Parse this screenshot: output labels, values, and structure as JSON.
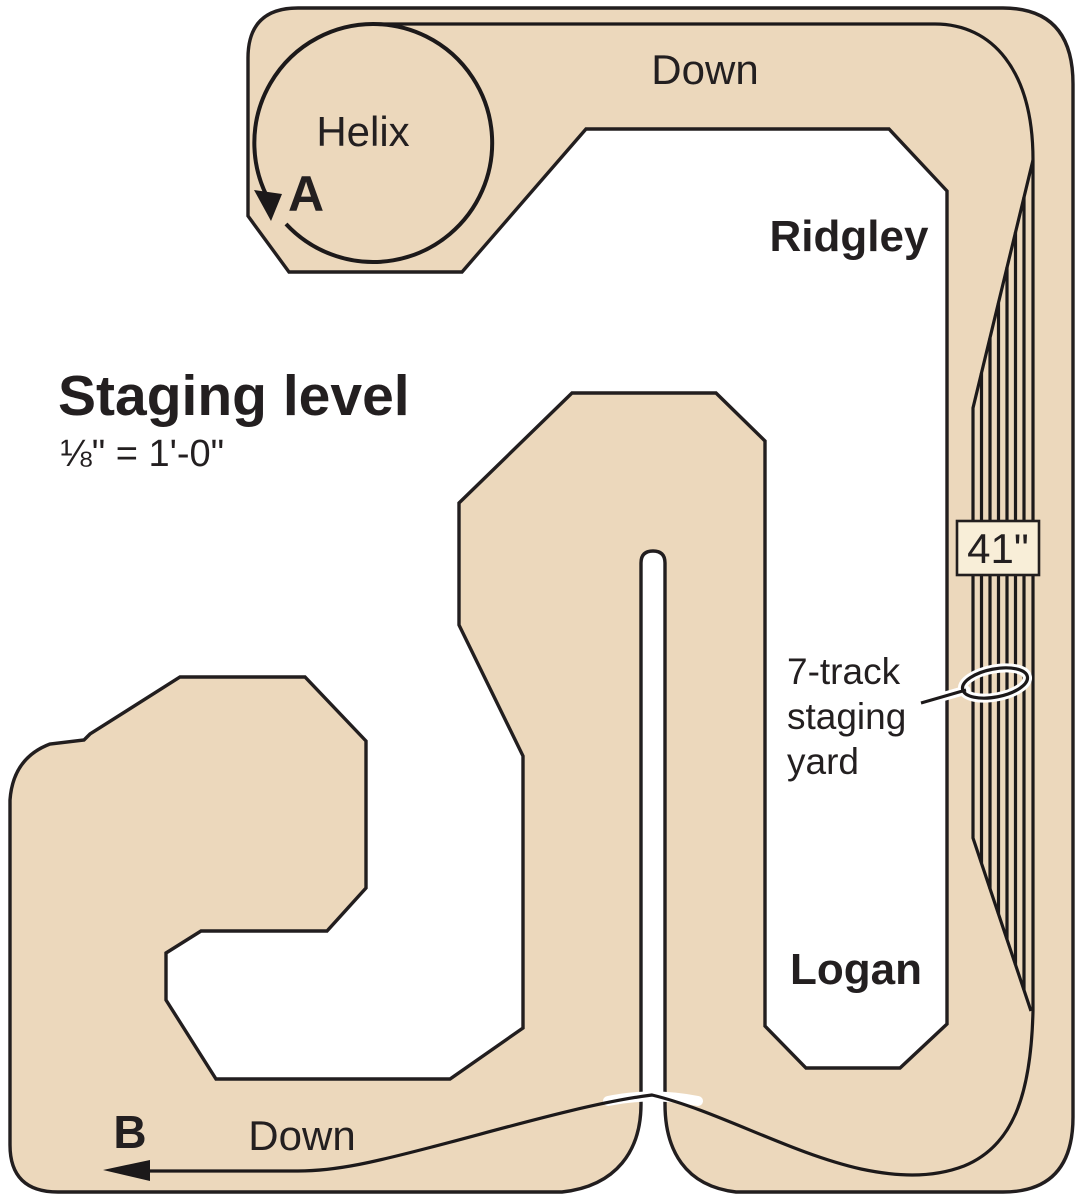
{
  "diagram": {
    "title": "Staging level",
    "scale_note": "⅛\" = 1'-0\"",
    "helix_label": "Helix",
    "connection_points": {
      "a": "A",
      "b": "B"
    },
    "direction_labels": {
      "top": "Down",
      "bottom": "Down"
    },
    "towns": {
      "ridgley": "Ridgley",
      "logan": "Logan"
    },
    "height_marker": "41\"",
    "yard_callout": {
      "line1": "7-track",
      "line2": "staging",
      "line3": "yard"
    },
    "colors": {
      "benchwork": "#ecd8bc",
      "marker_box": "#f8eed8",
      "ink": "#231f20",
      "background": "#ffffff"
    }
  }
}
